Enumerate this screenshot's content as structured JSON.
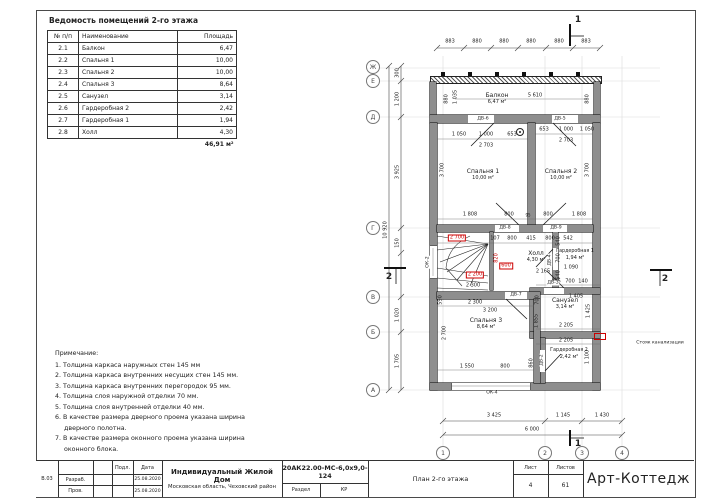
{
  "schedule": {
    "title": "Ведомость помещений 2-го этажа",
    "headers": {
      "num": "№ п/п",
      "name": "Наименование",
      "area": "Площадь"
    },
    "rows": [
      {
        "num": "2.1",
        "name": "Балкон",
        "area": "6,47"
      },
      {
        "num": "2.2",
        "name": "Спальня 1",
        "area": "10,00"
      },
      {
        "num": "2.3",
        "name": "Спальня 2",
        "area": "10,00"
      },
      {
        "num": "2.4",
        "name": "Спальня 3",
        "area": "8,64"
      },
      {
        "num": "2.5",
        "name": "Санузел",
        "area": "3,14"
      },
      {
        "num": "2.6",
        "name": "Гардеробная 2",
        "area": "2,42"
      },
      {
        "num": "2.7",
        "name": "Гардеробная 1",
        "area": "1,94"
      },
      {
        "num": "2.8",
        "name": "Холл",
        "area": "4,30"
      }
    ],
    "total": "46,91 м²"
  },
  "notes": {
    "title": "Примечание:",
    "items": [
      "1. Толщина каркаса наружных стен 145 мм",
      "2. Толщина каркаса внутренних несущих стен 145 мм.",
      "3. Толщина каркаса внутренних перегородок 95 мм.",
      "4. Толщина слоя наружной отделки 70 мм.",
      "5. Толщина слоя внутренней отделки 40 мм.",
      "6. В качестве размера дверного проема указана ширина дверного полотна.",
      "7. В качестве размера оконного проема указана ширина оконного блока."
    ]
  },
  "plan": {
    "rooms": [
      {
        "name": "Балкон",
        "area": "6,47 м²"
      },
      {
        "name": "Спальня 1",
        "area": "10,00 м²"
      },
      {
        "name": "Спальня 2",
        "area": "10,00 м²"
      },
      {
        "name": "Холл",
        "area": "4,30 м²"
      },
      {
        "name": "Гардеробная 1",
        "area": "1,94 м²"
      },
      {
        "name": "Спальня 3",
        "area": "8,64 м²"
      },
      {
        "name": "Санузел",
        "area": "3,14 м²"
      },
      {
        "name": "Гардеробная 2",
        "area": "2,42 м²"
      }
    ],
    "doors": [
      "ДВ-6",
      "ДВ-5",
      "ДВ-8",
      "ДВ-9",
      "ДВ-4",
      "ДВ-3",
      "ДВ-7",
      "ДВ-2"
    ],
    "windows": [
      "ОК-2",
      "ОК-4"
    ],
    "axes_bottom": [
      "1",
      "2",
      "3",
      "4"
    ],
    "axes_left": [
      "Ж",
      "Е",
      "Д",
      "Г",
      "В",
      "Б",
      "А"
    ],
    "sections": [
      "1",
      "2"
    ],
    "dims_top": [
      "883",
      "880",
      "880",
      "880",
      "880",
      "883"
    ],
    "dims_bottom": [
      "3 425",
      "1 145",
      "1 430",
      "6 000"
    ],
    "dims_left": [
      "300",
      "1 200",
      "3 925",
      "150",
      "1 020",
      "1 705",
      "10 920"
    ],
    "dims_red": [
      "2 700",
      "820",
      "600",
      "2 200"
    ],
    "dims_inner": [
      "5 610",
      "880",
      "1 035",
      "880",
      "1 050",
      "1 000",
      "653",
      "2 703",
      "653",
      "1 000",
      "1 050",
      "2 703",
      "3 700",
      "3 700",
      "1 808",
      "800",
      "95",
      "800",
      "1 808",
      "107",
      "800",
      "415",
      "800",
      "542",
      "2 165",
      "425",
      "700",
      "140",
      "1 405",
      "1 425",
      "2 205",
      "2 205",
      "1 100",
      "1 090",
      "540",
      "700",
      "540",
      "2 300",
      "3 200",
      "2 700",
      "1 550",
      "800",
      "860",
      "1 855",
      "700",
      "2 300",
      "590"
    ],
    "stack_label": "Стояк канализации"
  },
  "titleblock": {
    "sheet_code": "В.03",
    "row_labels": [
      "Разраб.",
      "Пров."
    ],
    "col_headers": [
      "Подл.",
      "Дата"
    ],
    "dates": [
      "25.08.2020",
      "25.08.2020"
    ],
    "project": "Индивидуальный Жилой Дом",
    "location": "Московская область, Чеховский район",
    "doc_code": "20АК22.00-МС-6,0х9,0-124",
    "section_label": "Раздел",
    "section_value": "КР",
    "sheet_title": "План 2-го этажа",
    "sheet_label": "Лист",
    "sheet_num": "4",
    "sheets_label": "Листов",
    "sheets_num": "61",
    "company": "Арт-Коттедж"
  }
}
